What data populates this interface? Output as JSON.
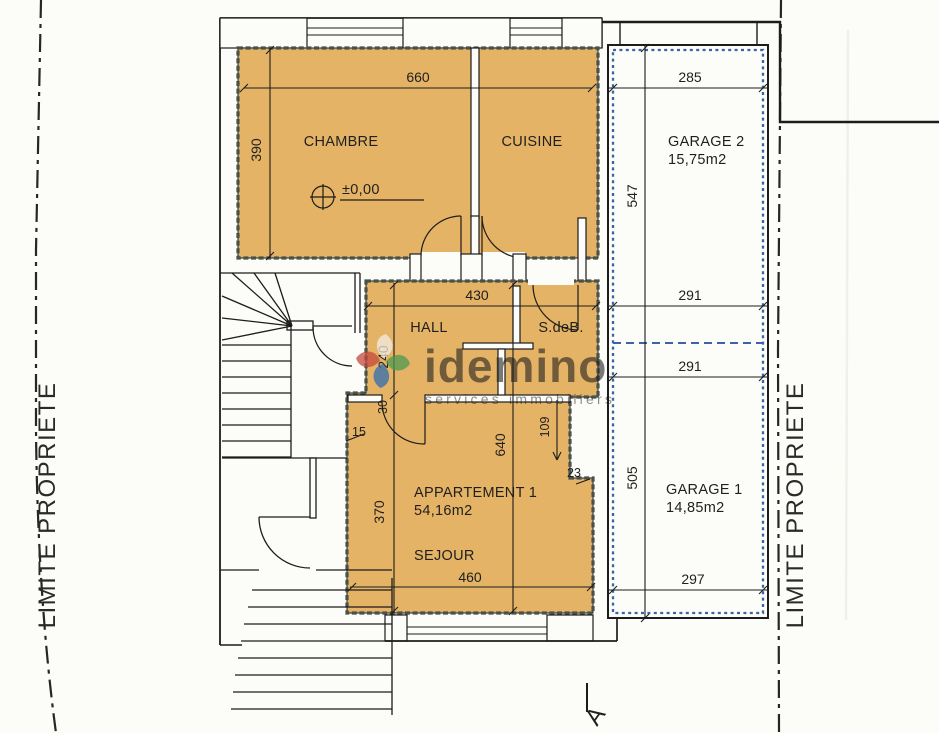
{
  "plan": {
    "boundary": {
      "left_label": "LIMITE PROPRIETE",
      "right_label": "LIMITE PROPRIETE"
    },
    "watermark": {
      "brand": "idemino",
      "tagline": "services immobiliers"
    },
    "level_marker": "±0,00",
    "section_label": "A",
    "rooms": {
      "chambre": "CHAMBRE",
      "cuisine": "CUISINE",
      "hall": "HALL",
      "sdeb": "S.deB.",
      "sejour": "SEJOUR",
      "apartment_name": "APPARTEMENT 1",
      "apartment_area": "54,16m2",
      "garage2_name": "GARAGE 2",
      "garage2_area": "15,75m2",
      "garage1_name": "GARAGE 1",
      "garage1_area": "14,85m2"
    },
    "dims": {
      "d660": "660",
      "d390": "390",
      "d285": "285",
      "d547": "547",
      "d430": "430",
      "d291_upper": "291",
      "d291_lower": "291",
      "d240": "240",
      "d30": "30",
      "d15": "15",
      "d370": "370",
      "d640": "640",
      "d109": "109",
      "d23": "23",
      "d505": "505",
      "d460": "460",
      "d297": "297"
    },
    "colors": {
      "apartment_fill": "#e4b365",
      "apartment_border": "#47524a",
      "garage_outline": "#3c62a8",
      "line": "#1c1c1c",
      "watermark": "#8d8475",
      "petal_white": "#f1eee6",
      "petal_green": "#4d9b52",
      "petal_blue": "#2e6cb0",
      "petal_red": "#c4483e"
    }
  }
}
